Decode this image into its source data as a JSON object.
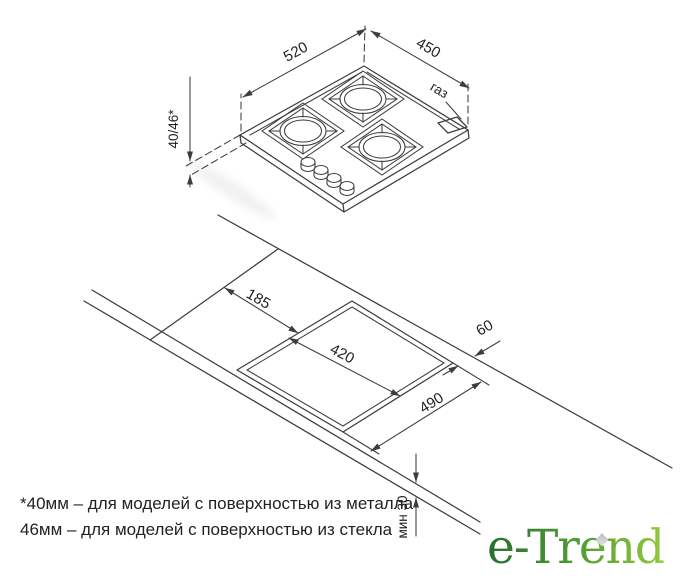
{
  "hob_view": {
    "width_mm": "520",
    "depth_mm": "450",
    "height_mm": "40/46*",
    "gas_label": "газ"
  },
  "cutout_view": {
    "offset_left_mm": "185",
    "cutout_depth_mm": "420",
    "cutout_width_mm": "490",
    "rear_clearance_mm": "60",
    "min_thickness_mm": "мин 30"
  },
  "footnote": {
    "line1": "*40мм – для моделей с поверхностью из металла",
    "line2": "46мм – для моделей с поверхностью из стекла"
  },
  "logo": {
    "text": "e-Trend"
  },
  "colors": {
    "background": "#ffffff",
    "line": "#3d3d3d",
    "text": "#222222",
    "logo_gradient_start": "#26702f",
    "logo_gradient_end": "#94c83d",
    "leaf": "#c8c8c8"
  }
}
